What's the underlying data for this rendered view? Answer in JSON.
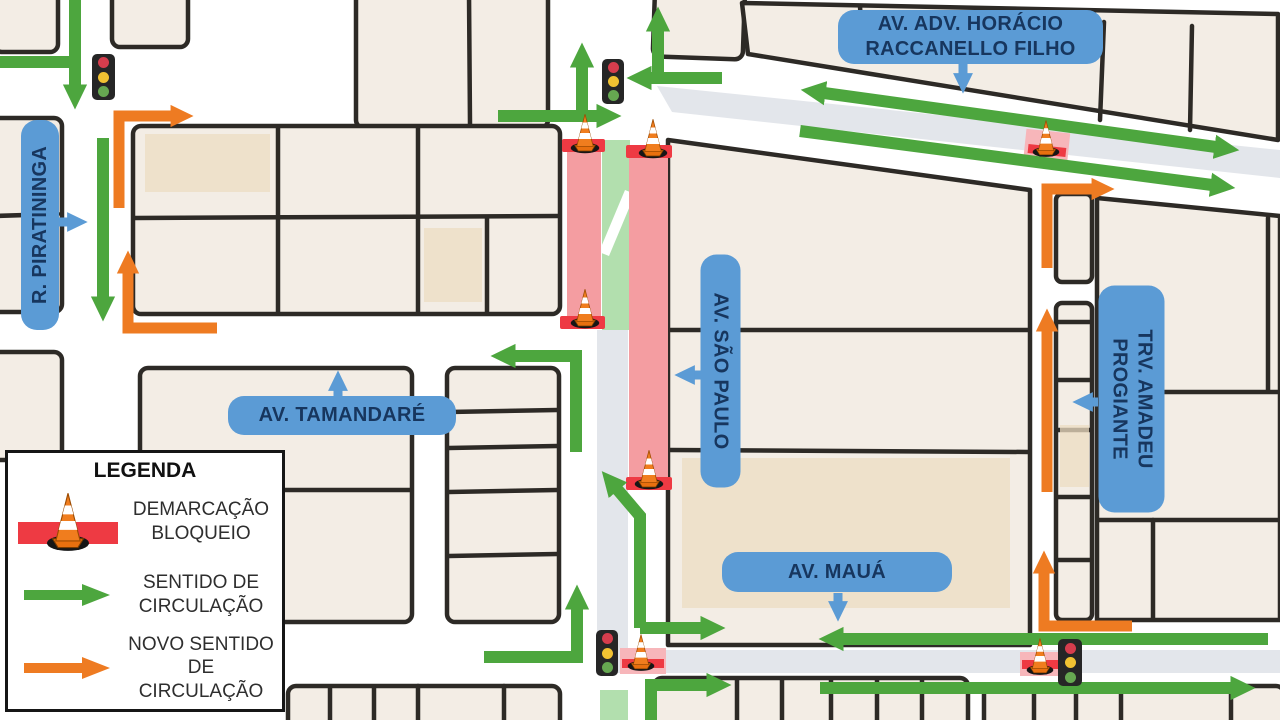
{
  "map_title": "Mapa de alteração de circulação viária",
  "colors": {
    "direction_green": "#4da63e",
    "new_direction_orange": "#ee7b22",
    "label_blue": "#5b9bd5",
    "label_text_navy": "#17365e",
    "blockade_red": "#ee3a43",
    "blockade_pink": "#f49da1",
    "open_lane_green": "#b2dfae",
    "road_gray": "#e3e6eb",
    "block_fill": "#f3ede5",
    "block_outline": "#2d2a26"
  },
  "street_labels": [
    {
      "id": "horacio",
      "line1": "AV. ADV. HORÁCIO",
      "line2": "RACCANELLO FILHO"
    },
    {
      "id": "piratininga",
      "text": "R. PIRATININGA"
    },
    {
      "id": "tamandare",
      "text": "AV. TAMANDARÉ"
    },
    {
      "id": "sao-paulo",
      "text": "AV. SÃO PAULO"
    },
    {
      "id": "maua",
      "text": "AV. MAUÁ"
    },
    {
      "id": "trv",
      "line1": "TRV. AMADEU",
      "line2": "PROGIANTE"
    }
  ],
  "legend": {
    "title": "LEGENDA",
    "items": [
      {
        "icon": "traffic-cone-on-red-bar-icon",
        "label": "DEMARCAÇÃO BLOQUEIO"
      },
      {
        "icon": "green-arrow-icon",
        "label": "SENTIDO DE CIRCULAÇÃO"
      },
      {
        "icon": "orange-arrow-icon",
        "label": "NOVO SENTIDO DE CIRCULAÇÃO"
      }
    ]
  },
  "icons": {
    "traffic_light": "traffic-light-icon",
    "traffic_cone": "traffic-cone-icon"
  }
}
